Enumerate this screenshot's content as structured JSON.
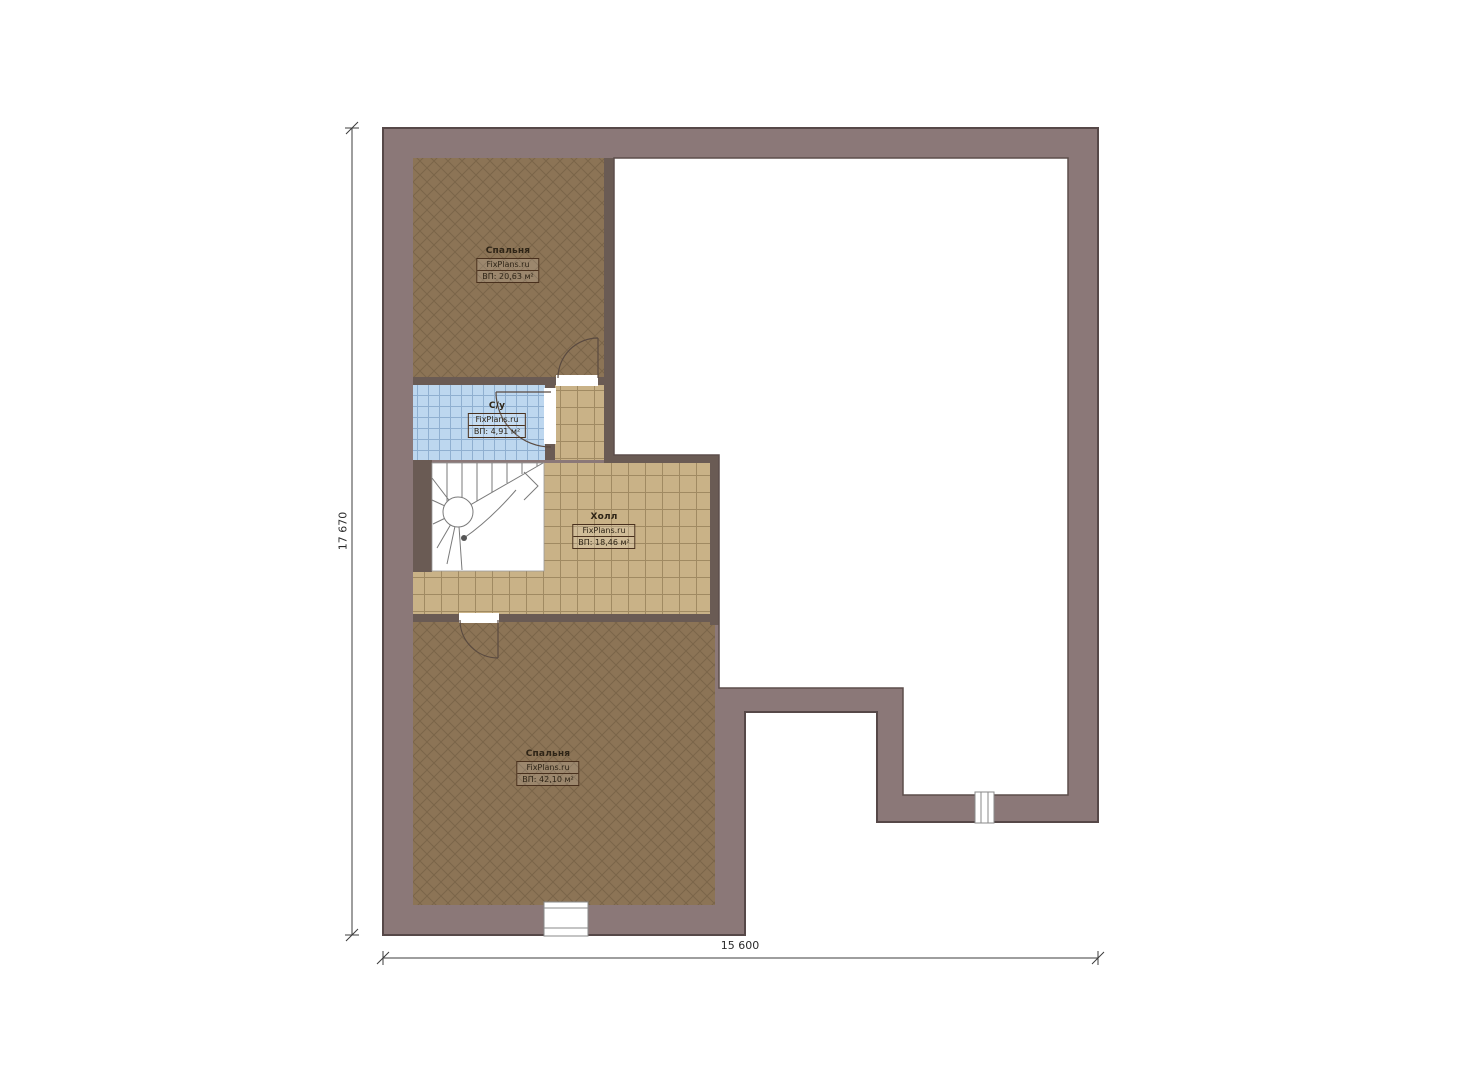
{
  "plan": {
    "title": "Floor plan — second level",
    "brand": "FixPlans.ru",
    "rooms": [
      {
        "name": "Спальня",
        "brand": "FixPlans.ru",
        "area": "ВП: 20,63 м²"
      },
      {
        "name": "С/у",
        "brand": "FixPlans.ru",
        "area": "ВП: 4,91 м²"
      },
      {
        "name": "Холл",
        "brand": "FixPlans.ru",
        "area": "ВП: 18,46 м²"
      },
      {
        "name": "Спальня",
        "brand": "FixPlans.ru",
        "area": "ВП: 42,10 м²"
      }
    ],
    "dimensions": {
      "height_mm": "17 670",
      "width_mm": "15 600"
    },
    "colors": {
      "wall_fill": "#8b7878",
      "wall_stroke": "#564848",
      "interior_wall": "#6a5b54",
      "bedroom_floor": "#8c7456",
      "hall_tile": "#c9b287",
      "bath_tile": "#bdd7ef",
      "void": "#ffffff"
    }
  }
}
